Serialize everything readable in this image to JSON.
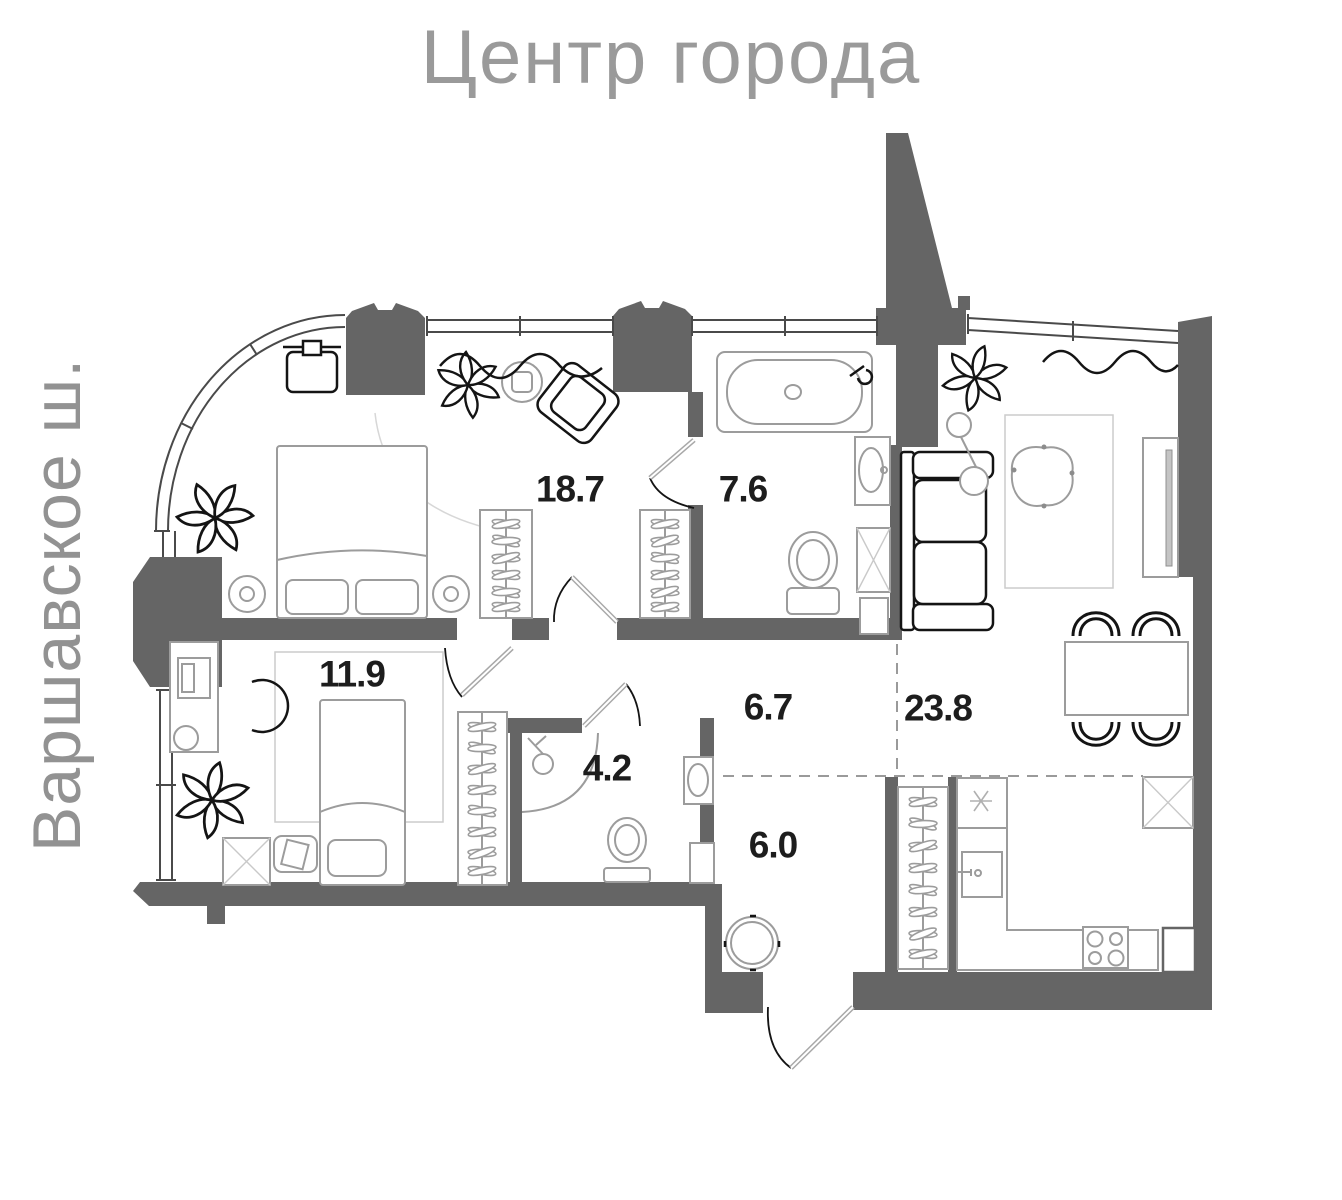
{
  "title": "Центр города",
  "street_label": "Варшавское ш.",
  "rooms": {
    "master_bedroom": {
      "area": "18.7"
    },
    "bathroom": {
      "area": "7.6"
    },
    "second_bedroom": {
      "area": "11.9"
    },
    "corridor": {
      "area": "6.7"
    },
    "shower_room": {
      "area": "4.2"
    },
    "hallway": {
      "area": "6.0"
    },
    "kitchen_living_room": {
      "area": "23.8"
    }
  },
  "colors": {
    "wall": "#656565",
    "area_text": "#1d1d1d",
    "title_text": "#9a9a9a",
    "furniture_line": "#9c9c9c",
    "furniture_dark": "#141414",
    "background": "#ffffff"
  }
}
